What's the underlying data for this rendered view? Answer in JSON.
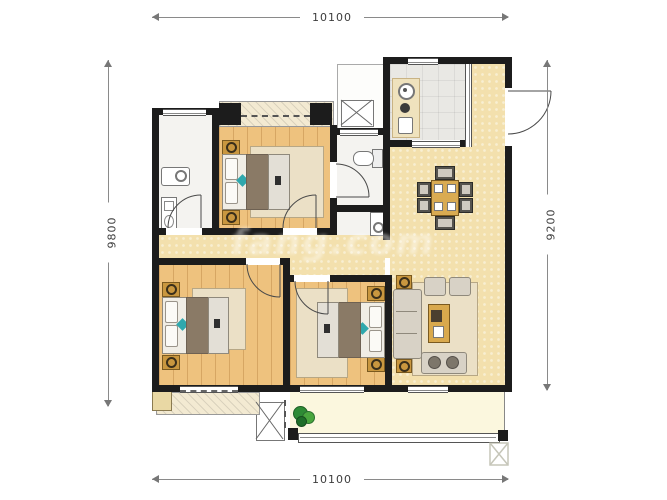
{
  "dimensions": {
    "top": {
      "value": "10100"
    },
    "bottom": {
      "value": "10100"
    },
    "left": {
      "value": "9800"
    },
    "right": {
      "value": "9200"
    }
  },
  "watermark": {
    "text": "fang.com"
  },
  "palette": {
    "wall": "#1c1c1c",
    "wood_floor": "#eec27e",
    "living_floor": "#f3e0ad",
    "tile_floor": "#e9e8e4",
    "balcony_floor": "#fbf7de",
    "rug": "#ebe0c6",
    "counter": "#efe2bd",
    "gold_furniture": "#c9973f",
    "sofa_gray": "#d8d2c6",
    "bed_blanket": "#8a7a66",
    "accent_teal": "#2fa8ad",
    "plant_green": "#2e8b35",
    "dimension_line": "#8a8a8a"
  }
}
